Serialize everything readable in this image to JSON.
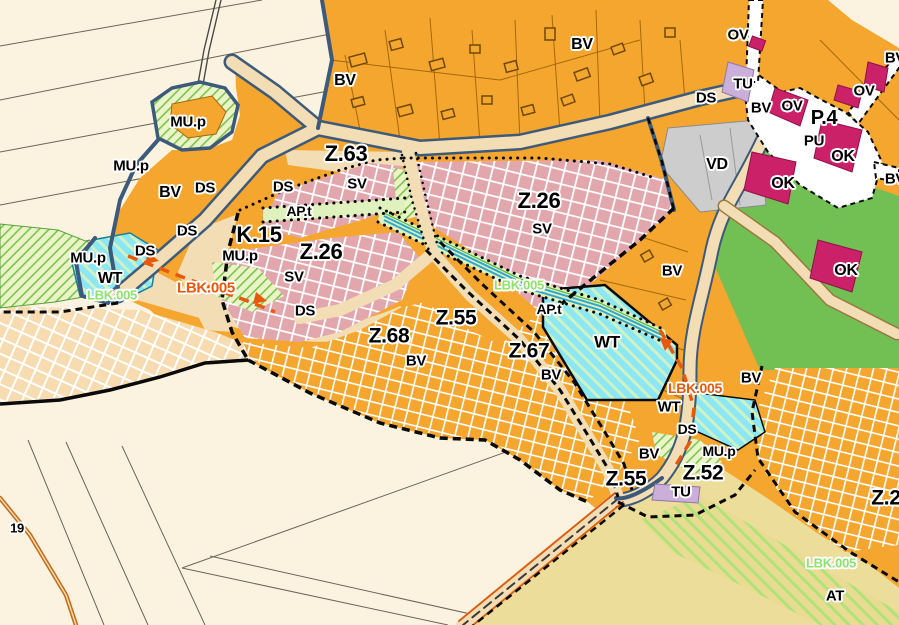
{
  "map": {
    "name": "municipal-zoning-plan-detail",
    "plan_codes_visible": [
      "Z.63",
      "Z.26",
      "K.15",
      "Z.68",
      "Z.55",
      "Z.67",
      "Z.52",
      "Z.2",
      "P.4"
    ],
    "zone_codes_visible": [
      "BV",
      "SV",
      "MU.p",
      "DS",
      "WT",
      "TU",
      "OV",
      "OK",
      "PU",
      "VD",
      "AP.t",
      "AT",
      "LBK.005"
    ],
    "parcel_number_visible": "19"
  },
  "colors": {
    "cream": "#FBF3DF",
    "village_orange": "#F5A62E",
    "pink_zone": "#E2A6AD",
    "peach_zone": "#F6DCB0",
    "water_cyan": "#8BE7F4",
    "road_tan": "#F3DDB4",
    "road_edge_navy": "#3D5A7B",
    "park_green": "#72C053",
    "civic_magenta": "#CB2168",
    "tech_lavender": "#C9AFD9",
    "production_gray": "#CDCDCD",
    "agri_yellow": "#EDDD9A",
    "lbkOrange": "#E8590C",
    "lbkGreen": "#8FE16F",
    "corridor_green": "#DFF2BE",
    "stream_blue": "#2FA8CE",
    "parcel_line": "#6F6355",
    "orange_parcel_line": "#A4690B",
    "boundary_black": "#0A0A0A",
    "white_road": "#FFFFFF"
  },
  "labels": [
    {
      "text": "MU.p",
      "x": 188,
      "y": 122,
      "size": 15,
      "c": "k"
    },
    {
      "text": "MU.p",
      "x": 131,
      "y": 166,
      "size": 15,
      "c": "k"
    },
    {
      "text": "BV",
      "x": 170,
      "y": 193,
      "size": 16,
      "c": "k"
    },
    {
      "text": "DS",
      "x": 205,
      "y": 188,
      "size": 15,
      "c": "k"
    },
    {
      "text": "DS",
      "x": 283,
      "y": 187,
      "size": 15,
      "c": "k"
    },
    {
      "text": "DS",
      "x": 187,
      "y": 231,
      "size": 15,
      "c": "k"
    },
    {
      "text": "MU.p",
      "x": 88,
      "y": 258,
      "size": 15,
      "c": "k"
    },
    {
      "text": "DS",
      "x": 145,
      "y": 251,
      "size": 15,
      "c": "k"
    },
    {
      "text": "WT",
      "x": 110,
      "y": 279,
      "size": 16,
      "c": "k"
    },
    {
      "text": "LBK.005",
      "x": 112,
      "y": 295,
      "size": 13,
      "c": "g"
    },
    {
      "text": "MU.p",
      "x": 240,
      "y": 256,
      "size": 15,
      "c": "k"
    },
    {
      "text": "K.15",
      "x": 259,
      "y": 235,
      "size": 22,
      "c": "k"
    },
    {
      "text": "Z.26",
      "x": 321,
      "y": 252,
      "size": 22,
      "c": "k"
    },
    {
      "text": "SV",
      "x": 294,
      "y": 277,
      "size": 15,
      "c": "k"
    },
    {
      "text": "DS",
      "x": 305,
      "y": 311,
      "size": 15,
      "c": "k"
    },
    {
      "text": "LBK.005",
      "x": 206,
      "y": 288,
      "size": 15,
      "c": "o"
    },
    {
      "text": "Z.63",
      "x": 346,
      "y": 154,
      "size": 22,
      "c": "k"
    },
    {
      "text": "SV",
      "x": 357,
      "y": 184,
      "size": 15,
      "c": "k"
    },
    {
      "text": "AP.t",
      "x": 299,
      "y": 211,
      "size": 14,
      "c": "k"
    },
    {
      "text": "Z.26",
      "x": 539,
      "y": 201,
      "size": 22,
      "c": "k"
    },
    {
      "text": "SV",
      "x": 542,
      "y": 229,
      "size": 15,
      "c": "k"
    },
    {
      "text": "LBK.005",
      "x": 519,
      "y": 285,
      "size": 13,
      "c": "g"
    },
    {
      "text": "AP.t",
      "x": 549,
      "y": 309,
      "size": 14,
      "c": "k"
    },
    {
      "text": "BV",
      "x": 582,
      "y": 45,
      "size": 16,
      "c": "k"
    },
    {
      "text": "BV",
      "x": 345,
      "y": 81,
      "size": 16,
      "c": "k"
    },
    {
      "text": "OV",
      "x": 738,
      "y": 35,
      "size": 15,
      "c": "k"
    },
    {
      "text": "DS",
      "x": 706,
      "y": 98,
      "size": 15,
      "c": "k"
    },
    {
      "text": "TU",
      "x": 743,
      "y": 84,
      "size": 15,
      "c": "k"
    },
    {
      "text": "BV",
      "x": 761,
      "y": 108,
      "size": 15,
      "c": "k"
    },
    {
      "text": "OV",
      "x": 792,
      "y": 106,
      "size": 15,
      "c": "k"
    },
    {
      "text": "P.4",
      "x": 824,
      "y": 118,
      "size": 20,
      "c": "k"
    },
    {
      "text": "OV",
      "x": 864,
      "y": 91,
      "size": 15,
      "c": "k"
    },
    {
      "text": "PU",
      "x": 814,
      "y": 141,
      "size": 15,
      "c": "k"
    },
    {
      "text": "OK",
      "x": 843,
      "y": 157,
      "size": 16,
      "c": "k"
    },
    {
      "text": "OK",
      "x": 783,
      "y": 184,
      "size": 16,
      "c": "k"
    },
    {
      "text": "VD",
      "x": 717,
      "y": 165,
      "size": 16,
      "c": "k"
    },
    {
      "text": "OK",
      "x": 846,
      "y": 271,
      "size": 16,
      "c": "k"
    },
    {
      "text": "BV",
      "x": 672,
      "y": 271,
      "size": 15,
      "c": "k"
    },
    {
      "text": "BV",
      "x": 895,
      "y": 58,
      "size": 15,
      "c": "k"
    },
    {
      "text": "BV",
      "x": 895,
      "y": 179,
      "size": 15,
      "c": "k"
    },
    {
      "text": "Z.68",
      "x": 389,
      "y": 336,
      "size": 21,
      "c": "k"
    },
    {
      "text": "BV",
      "x": 416,
      "y": 361,
      "size": 15,
      "c": "k"
    },
    {
      "text": "Z.55",
      "x": 456,
      "y": 318,
      "size": 21,
      "c": "k"
    },
    {
      "text": "Z.67",
      "x": 529,
      "y": 351,
      "size": 21,
      "c": "k"
    },
    {
      "text": "BV",
      "x": 551,
      "y": 375,
      "size": 15,
      "c": "k"
    },
    {
      "text": "WT",
      "x": 607,
      "y": 342,
      "size": 17,
      "c": "k"
    },
    {
      "text": "BV",
      "x": 751,
      "y": 378,
      "size": 15,
      "c": "k"
    },
    {
      "text": "LBK.005",
      "x": 695,
      "y": 388,
      "size": 14,
      "c": "o"
    },
    {
      "text": "WT",
      "x": 669,
      "y": 407,
      "size": 15,
      "c": "k"
    },
    {
      "text": "DS",
      "x": 687,
      "y": 429,
      "size": 14,
      "c": "k"
    },
    {
      "text": "BV",
      "x": 649,
      "y": 454,
      "size": 15,
      "c": "k"
    },
    {
      "text": "MU.p",
      "x": 719,
      "y": 451,
      "size": 14,
      "c": "k"
    },
    {
      "text": "Z.55",
      "x": 626,
      "y": 479,
      "size": 21,
      "c": "k"
    },
    {
      "text": "Z.52",
      "x": 703,
      "y": 473,
      "size": 21,
      "c": "k"
    },
    {
      "text": "TU",
      "x": 681,
      "y": 492,
      "size": 15,
      "c": "k"
    },
    {
      "text": "Z.2",
      "x": 886,
      "y": 498,
      "size": 21,
      "c": "k"
    },
    {
      "text": "LBK.005",
      "x": 831,
      "y": 563,
      "size": 13,
      "c": "g"
    },
    {
      "text": "AT",
      "x": 835,
      "y": 596,
      "size": 15,
      "c": "k"
    },
    {
      "text": "19",
      "x": 17,
      "y": 528,
      "size": 13,
      "c": "k"
    }
  ]
}
